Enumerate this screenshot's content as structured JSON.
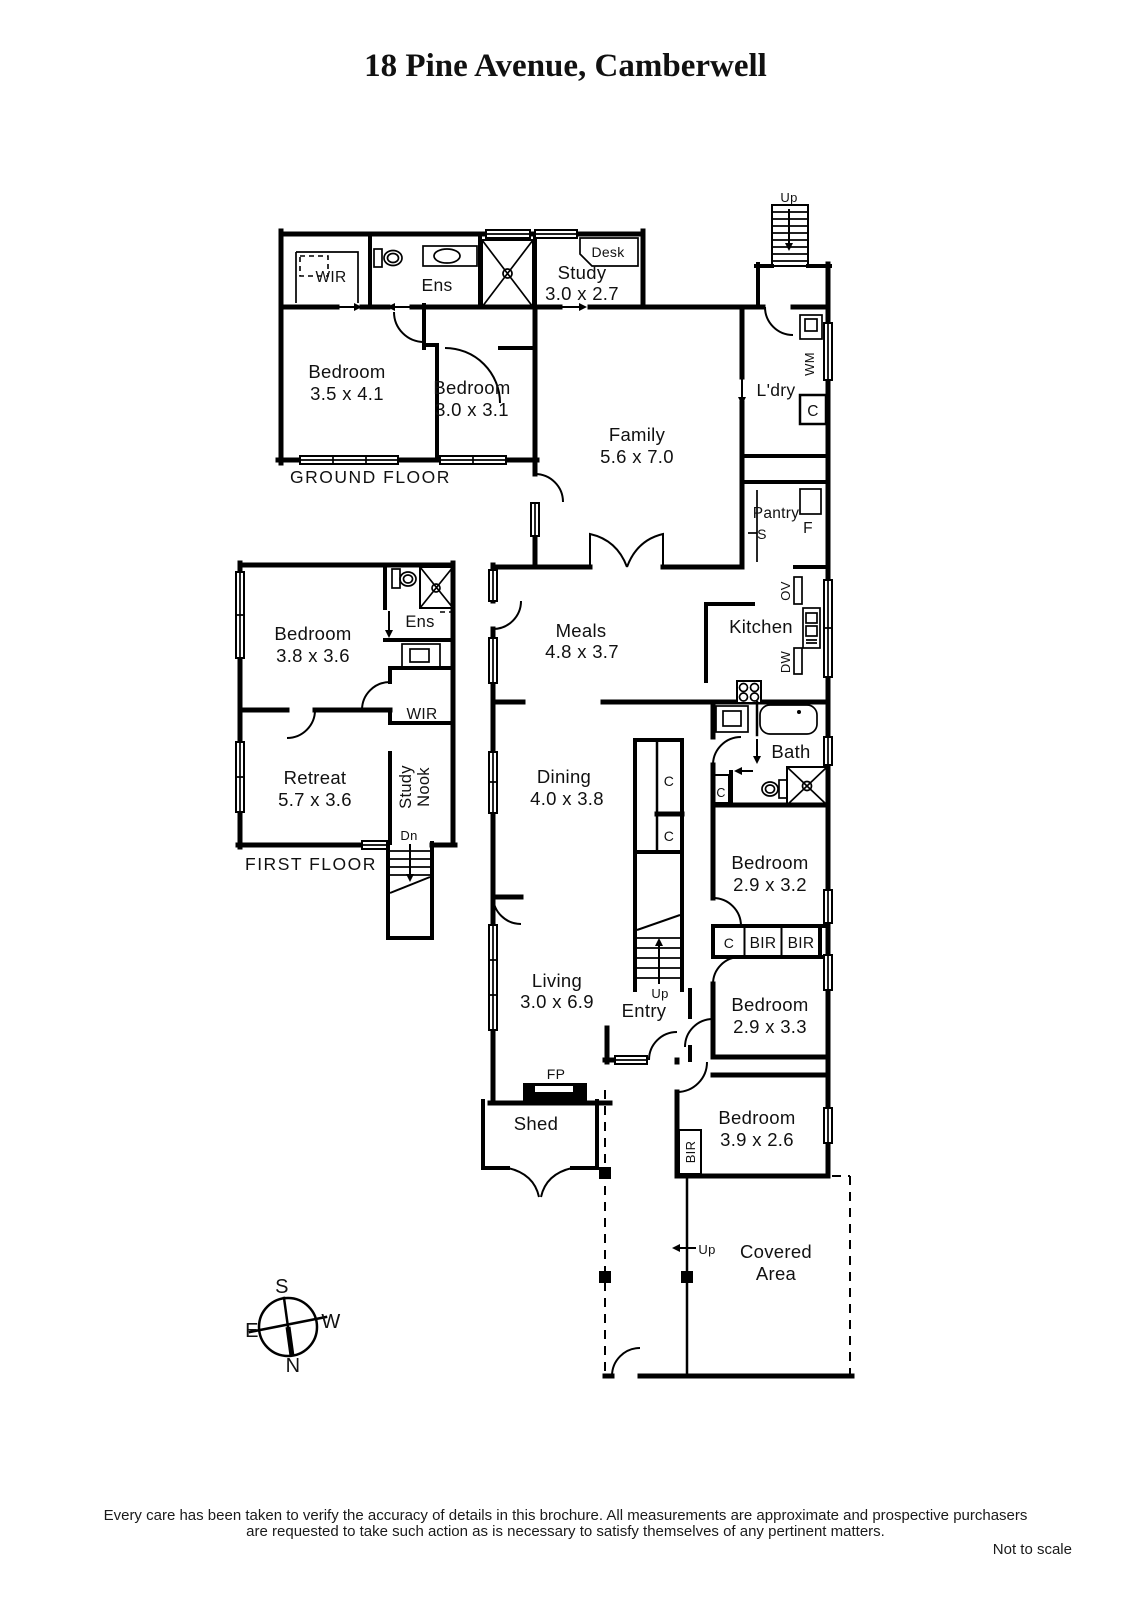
{
  "title": "18 Pine Avenue, Camberwell",
  "ground_floor": {
    "label": "GROUND FLOOR",
    "wir": "WIR",
    "ens": "Ens",
    "study": {
      "name": "Study",
      "dims": "3.0 x 2.7"
    },
    "desk": "Desk",
    "bedroom_a": {
      "name": "Bedroom",
      "dims": "3.5 x 4.1"
    },
    "bedroom_b": {
      "name": "Bedroom",
      "dims": "3.0 x 3.1"
    }
  },
  "first_floor": {
    "label": "FIRST FLOOR",
    "bedroom": {
      "name": "Bedroom",
      "dims": "3.8 x 3.6"
    },
    "ens": "Ens",
    "wir": "WIR",
    "retreat": {
      "name": "Retreat",
      "dims": "5.7 x 3.6"
    },
    "study_nook_line1": "Study",
    "study_nook_line2": "Nook",
    "stairs_down": "Dn"
  },
  "main_house": {
    "family": {
      "name": "Family",
      "dims": "5.6 x 7.0"
    },
    "laundry": "L'dry",
    "washing_machine": "WM",
    "laundry_cupboard": "C",
    "pantry": "Pantry",
    "pantry_sink": "S",
    "fridge": "F",
    "meals": {
      "name": "Meals",
      "dims": "4.8 x 3.7"
    },
    "kitchen": "Kitchen",
    "oven": "OV",
    "dishwasher": "DW",
    "bath": "Bath",
    "bath_cupboard": "C",
    "hall_cupboard_upper": "C",
    "hall_cupboard_lower": "C",
    "dining": {
      "name": "Dining",
      "dims": "4.0 x 3.8"
    },
    "bedroom_c": {
      "name": "Bedroom",
      "dims": "2.9 x 3.2"
    },
    "robe_cupboard": "C",
    "robe_bir_a": "BIR",
    "robe_bir_b": "BIR",
    "bedroom_d": {
      "name": "Bedroom",
      "dims": "2.9 x 3.3"
    },
    "living": {
      "name": "Living",
      "dims": "3.0 x 6.9"
    },
    "entry": "Entry",
    "fireplace": "FP",
    "shed": "Shed",
    "bedroom_e": {
      "name": "Bedroom",
      "dims": "3.9 x 2.6"
    },
    "bedroom_e_bir": "BIR",
    "covered_area_line1": "Covered",
    "covered_area_line2": "Area",
    "stairs_up_rear": "Up",
    "stairs_up_internal": "Up",
    "covered_up": "Up"
  },
  "compass": {
    "north": "N",
    "south": "S",
    "east": "E",
    "west": "W"
  },
  "footer": {
    "disclaimer_line1": "Every care has been taken to verify the accuracy of details in this brochure.  All measurements are approximate and prospective purchasers",
    "disclaimer_line2": "are requested to take such action as is necessary to satisfy themselves of any pertinent matters.",
    "not_to_scale": "Not to scale"
  },
  "colors": {
    "wall": "#000000",
    "background": "#ffffff"
  }
}
